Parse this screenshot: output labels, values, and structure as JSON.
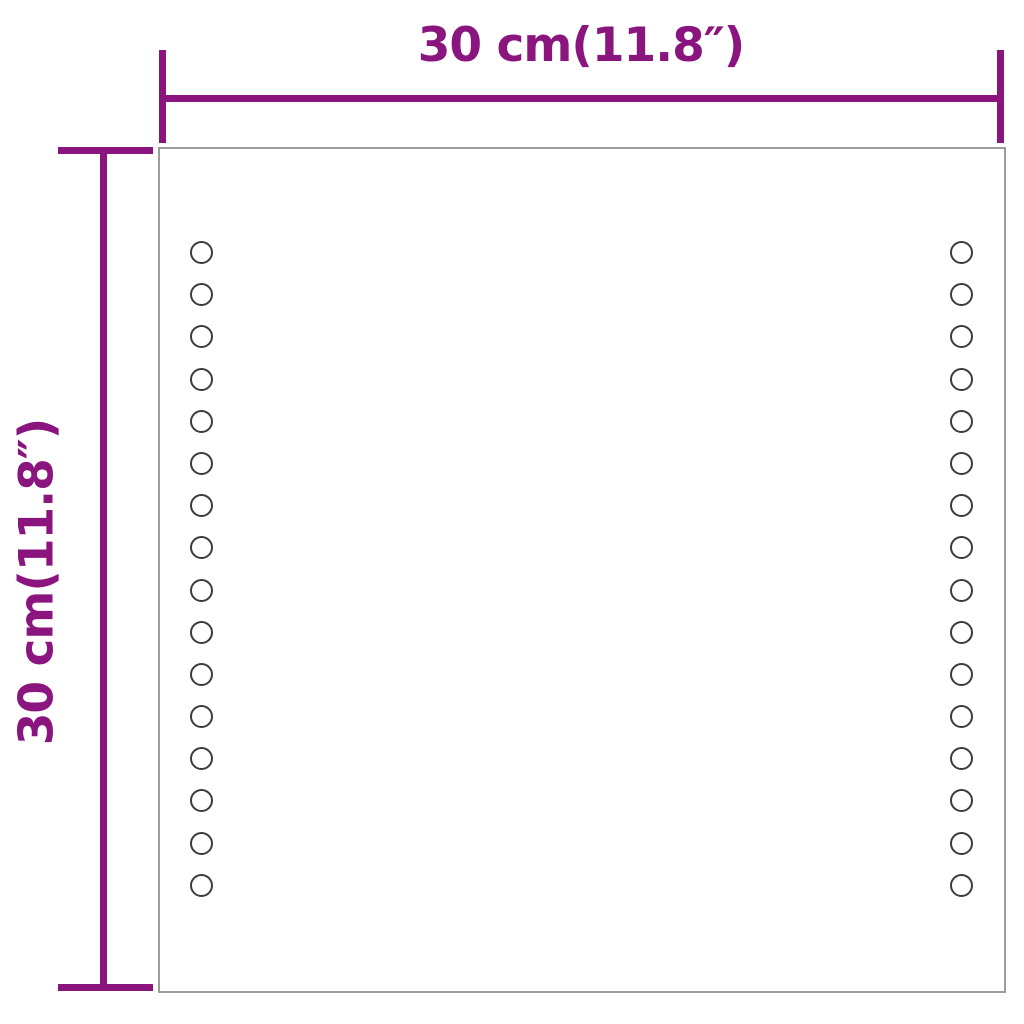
{
  "figure": {
    "kind": "product-dimension-diagram",
    "subject": "square-led-mirror-front-view",
    "background_color": "#ffffff"
  },
  "dimensions": {
    "width_label": "30 cm(11.8″)",
    "height_label": "30 cm(11.8″)"
  },
  "mirror": {
    "leds_per_column": 16,
    "led_columns": 2
  },
  "colors": {
    "dimension": "#8a157f",
    "mirror_border": "#9c9c9c",
    "led_stroke": "#3c3c3c"
  }
}
